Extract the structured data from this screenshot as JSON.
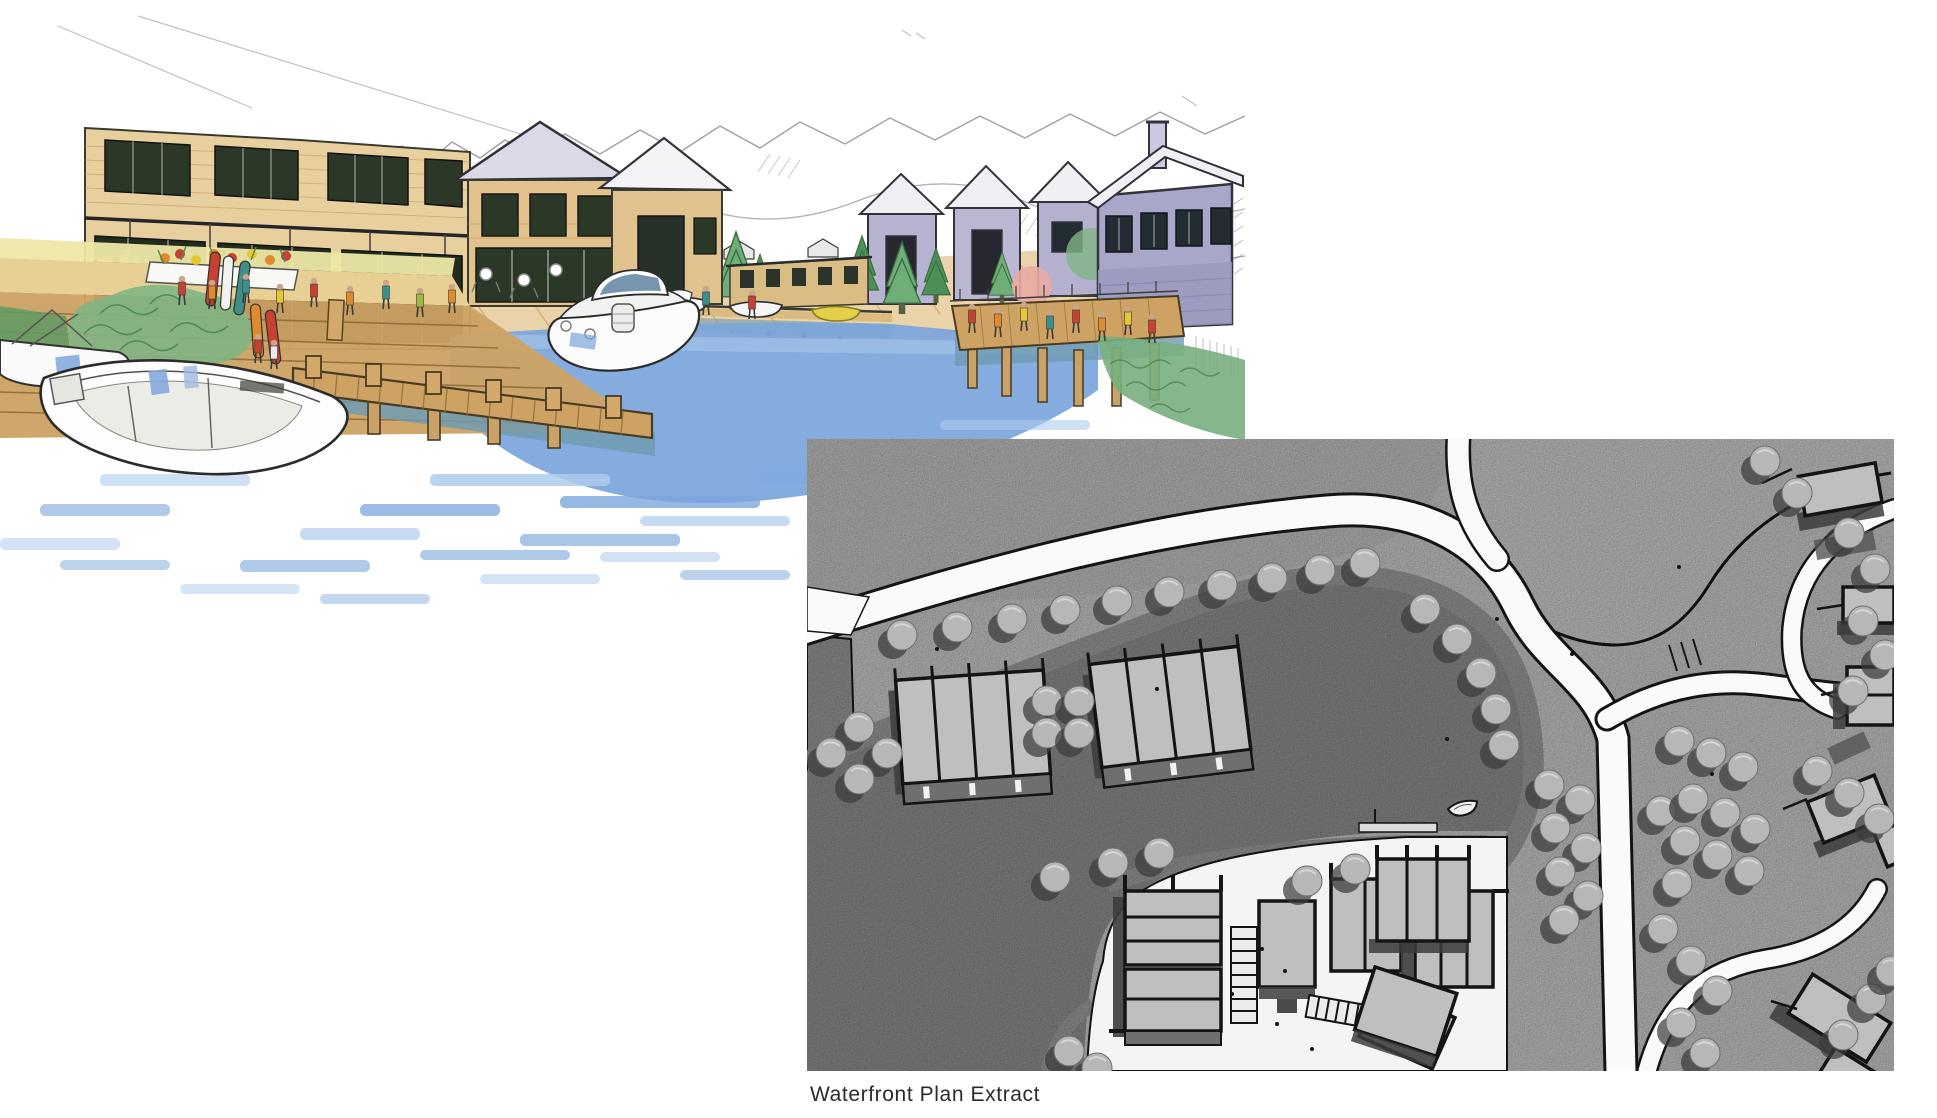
{
  "caption": "Waterfront Plan Extract",
  "palette": {
    "sketch_water": "#7CA6DC",
    "sketch_water_light": "#AECBEC",
    "sketch_water_dark": "#5B88C4",
    "sketch_water_teal": "#6E9BB1",
    "sketch_timber": "#CDA263",
    "sketch_timber_light": "#E2C58E",
    "sketch_roof_lavender": "#A9A7C9",
    "sketch_hillside_ochre": "#D8AF63",
    "sketch_foliage": "#5E9A62",
    "sketch_pencil": "#8A9097",
    "figure_red": "#C8402F",
    "figure_orange": "#E08A2E",
    "figure_yellow": "#E4C832",
    "figure_teal": "#3E8E8A",
    "plan_ground": "#C6C6C6",
    "plan_water": "#8D8D8D",
    "plan_beach": "#9A9A9A",
    "plan_road": "#FAFAFA",
    "plan_building": "#BFBFBF",
    "plan_tree": "#B7B7B7",
    "plan_shadow": "#3C3C3C",
    "plan_outline": "#141414"
  }
}
